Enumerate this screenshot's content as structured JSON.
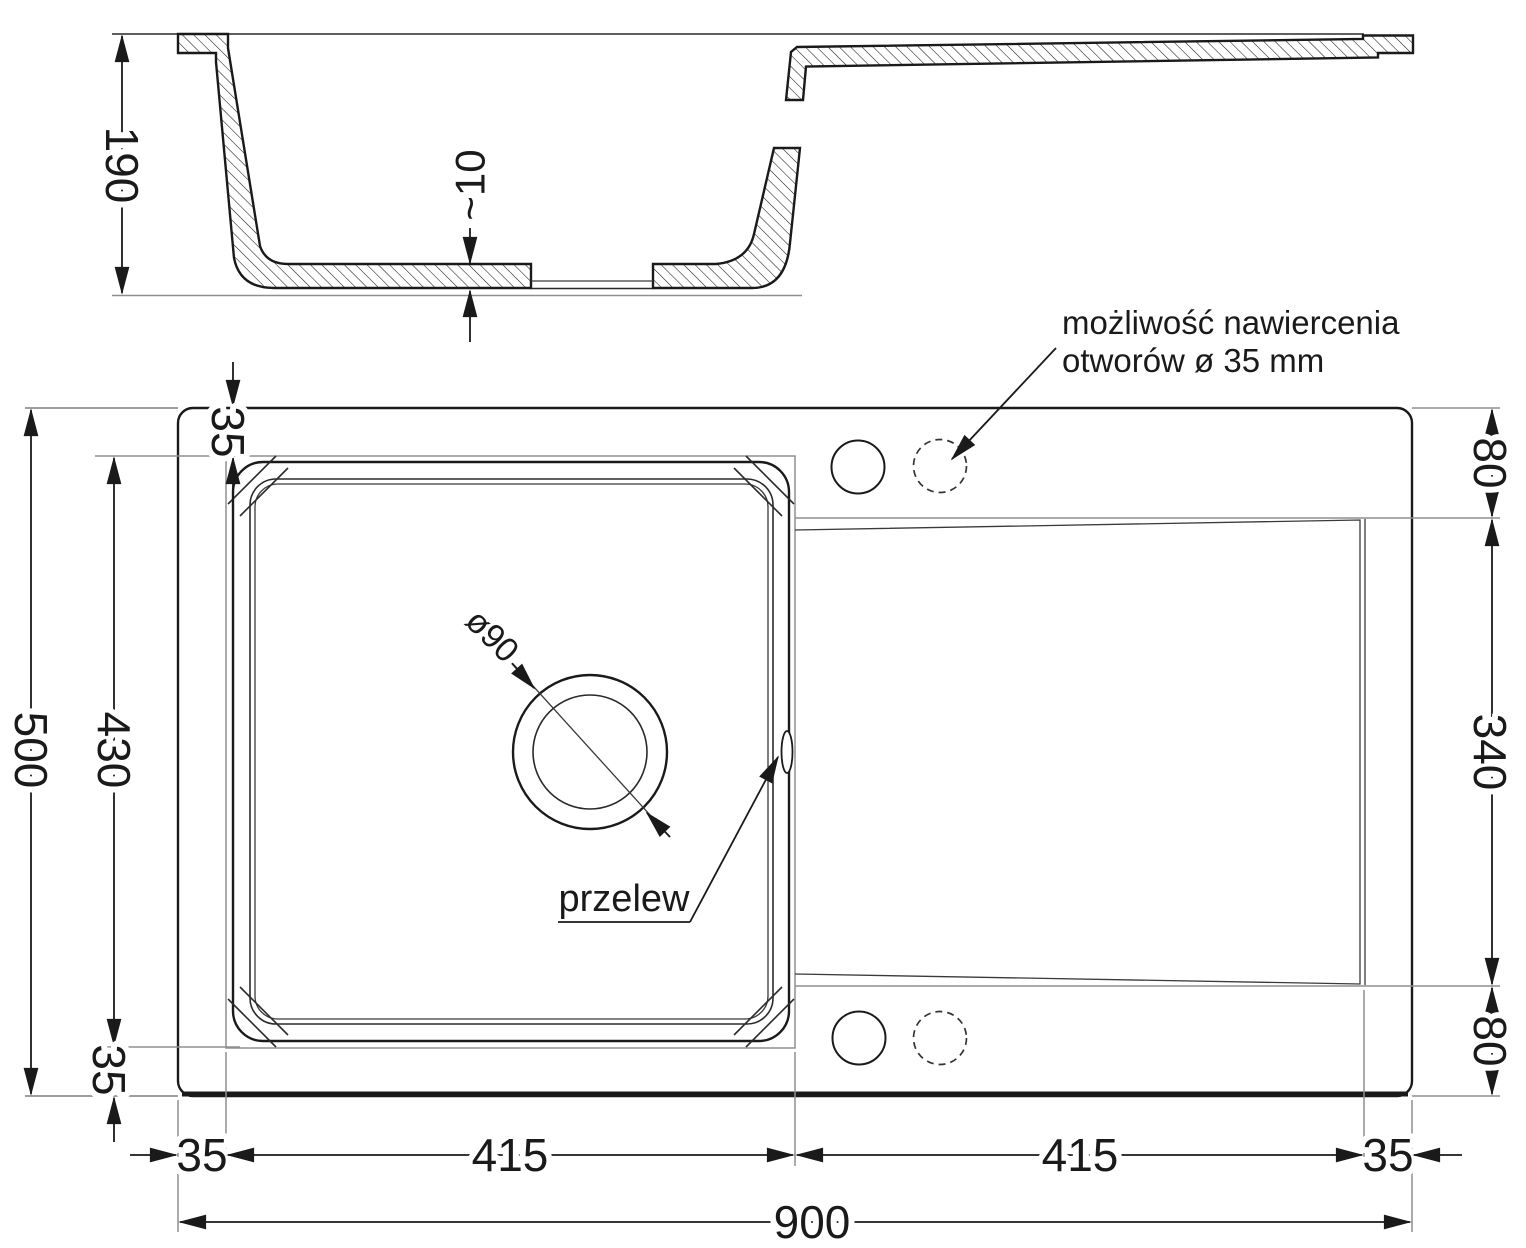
{
  "drawing_title": "kitchen sink technical drawing",
  "colors": {
    "line": "#1a1a1a",
    "reference": "#8f8f8f",
    "background": "#ffffff"
  },
  "section_view": {
    "height_dim": "190",
    "bottom_thickness_dim": "~10"
  },
  "plan_view": {
    "total_width_dim": "900",
    "total_depth_dim": "500",
    "bowl_depth_dim": "430",
    "bowl_width_dim": "415",
    "drainer_width_dim": "415",
    "rim_top_dim": "35",
    "rim_bottom_dim": "35",
    "rim_left_dim": "35",
    "rim_right_dim": "35",
    "hole_band_top_dim": "80",
    "hole_band_bottom_dim": "80",
    "drainer_depth_dim": "340",
    "drain_diameter_label": "ø90",
    "overflow_label": "przelew",
    "drill_note_line1": "możliwość nawiercenia",
    "drill_note_line2": "otworów ø 35 mm"
  }
}
